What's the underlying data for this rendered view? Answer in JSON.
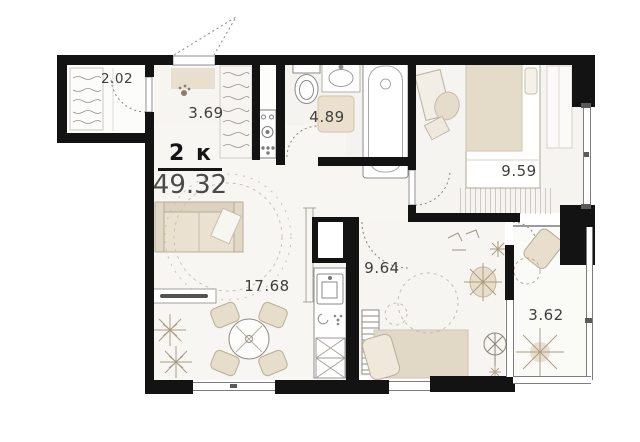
{
  "plan": {
    "type_label": "2 к",
    "total_area": "49.32",
    "rooms": [
      {
        "name": "wardrobe",
        "area": "2.02"
      },
      {
        "name": "hallway",
        "area": "3.69"
      },
      {
        "name": "bathroom",
        "area": "4.89"
      },
      {
        "name": "bedroom",
        "area": "9.59"
      },
      {
        "name": "living-room",
        "area": "17.68"
      },
      {
        "name": "kitchen-room",
        "area": "9.64"
      },
      {
        "name": "balcony",
        "area": "3.62"
      }
    ],
    "colors": {
      "wall": "#131313",
      "furniture_beige": "#e6dcca",
      "floor": "#f7f6f3",
      "label_text": "#3f3e3c"
    }
  }
}
